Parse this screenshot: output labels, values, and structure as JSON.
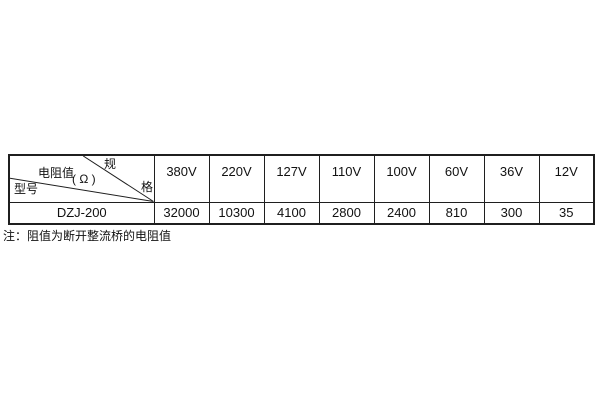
{
  "colors": {
    "border": "#1f1f1f",
    "text": "#111111",
    "background": "#ffffff"
  },
  "table": {
    "corner": {
      "spec_char_top": "规",
      "spec_char_bottom": "格",
      "resistance_label": "电阻值",
      "resistance_unit": "( Ω )",
      "model_label": "型号"
    },
    "voltage_headers": [
      "380V",
      "220V",
      "127V",
      "110V",
      "100V",
      "60V",
      "36V",
      "12V"
    ],
    "rows": [
      {
        "model": "DZJ-200",
        "values": [
          "32000",
          "10300",
          "4100",
          "2800",
          "2400",
          "810",
          "300",
          "35"
        ]
      }
    ]
  },
  "note": "注：阻值为断开整流桥的电阻值"
}
